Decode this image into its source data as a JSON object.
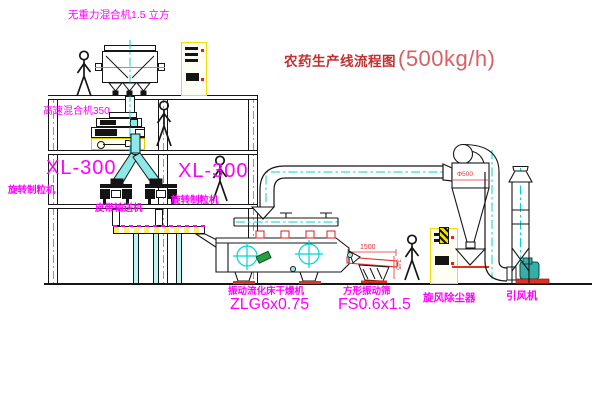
{
  "diagram": {
    "title_text": "农药生产线流程图",
    "title_capacity": "(500kg/h)"
  },
  "equipment_labels": {
    "weightless_mixer": "无重力混合机1.5 立方",
    "high_speed_mixer": "高速混合机350",
    "left_granulator_model": "XL-300",
    "left_granulator_name": "旋转制粒机",
    "right_granulator_model": "XL-300",
    "right_granulator_name": "旋转制粒机",
    "belt_conveyor": "皮带输送机",
    "fluid_bed_dryer_name": "振动流化床干燥机",
    "fluid_bed_dryer_model": "ZLG6x0.75",
    "square_screen_name": "方形振动筛",
    "square_screen_model": "FS0.6x1.5",
    "cyclone_collector": "旋风除尘器",
    "induced_draft_fan": "引风机"
  },
  "dimension_labels": {
    "screen_length": "1500",
    "screen_height": "345",
    "cyclone_diameter": "Φ500"
  },
  "colors": {
    "label_magenta": "#ff00ff",
    "title_red": "#c23030",
    "line_black": "#161616",
    "centerline_cyan": "#00d5d5",
    "panel_yellow": "#f0e000",
    "accent_red": "#e03020",
    "fan_teal": "#35b0a8",
    "item_green": "#2a9f40"
  }
}
